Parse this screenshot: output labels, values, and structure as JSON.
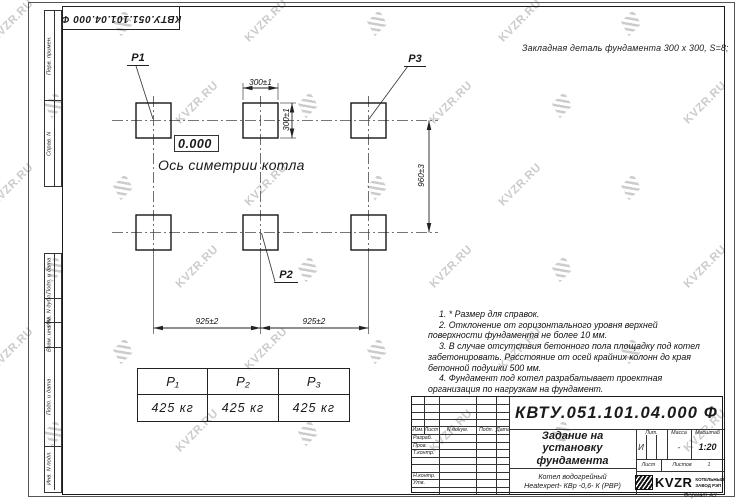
{
  "watermark": {
    "text": "KVZR.RU"
  },
  "stamp_top": {
    "text": "КВТУ.051.101.04.000  Ф"
  },
  "sidebar": {
    "top": [
      "Перв. примен.",
      "Справ. N"
    ],
    "bottom": [
      "Подп. и дата",
      "Инв. N дубл.",
      "Взам. инв. N",
      "Подп. и дата",
      "Инв. N подл."
    ]
  },
  "drawing": {
    "embed_note": "Закладная деталь фундамента  300 x 300,  S=8;",
    "elevation": "0.000",
    "axis_label": "Ось симетрии котла",
    "plates": {
      "p1": "P1",
      "p2": "P2",
      "p3": "P3"
    },
    "dims": {
      "w300_top": "300±1",
      "w300_side": "300±1",
      "h960": "960±3",
      "w925_left": "925±2",
      "w925_right": "925±2"
    }
  },
  "notes": [
    "1. * Размер для справок.",
    "2. Отклонение от горизонтального уровня верхней поверхности фундамента не более 10 мм.",
    "3. В случае отсутствия бетонного пола площадку под котел забетонировать. Расстояние от осей крайних колонн до края бетонной подушки 500 мм.",
    "4. Фундамент под котел разрабатывает проектная организация по нагрузкам на фундамент."
  ],
  "load_table": {
    "headers": [
      "P₁",
      "P₂",
      "P₃"
    ],
    "values": [
      "425 кг",
      "425 кг",
      "425 кг"
    ]
  },
  "titleblock": {
    "doc_number": "КВТУ.051.101.04.000  Ф",
    "title_lines": [
      "Задание на",
      "установку",
      "фундамента"
    ],
    "product_lines": [
      "Котел водогрейный",
      "Heatexpert- КВр -0,6- К (РВР)"
    ],
    "header_cells": [
      "Изм.",
      "Лист",
      "N докум.",
      "Подп.",
      "Дата"
    ],
    "row_labels": [
      "Разраб.",
      "Пров.",
      "Т.контр.",
      "Н.контр.",
      "Утв."
    ],
    "lit_label": "Лит.",
    "lit_value": "И",
    "mass_label": "Масса",
    "mass_value": "-",
    "scale_label": "Масштаб",
    "scale_value": "1:20",
    "sheet_label": "Лист",
    "sheets_label": "Листов",
    "sheets_value": "1",
    "logo_text": "KVZR",
    "logo_sub1": "КОТЕЛЬНЫЙ",
    "logo_sub2": "ЗАВОД РЭП",
    "format_label": "Формат А3"
  }
}
